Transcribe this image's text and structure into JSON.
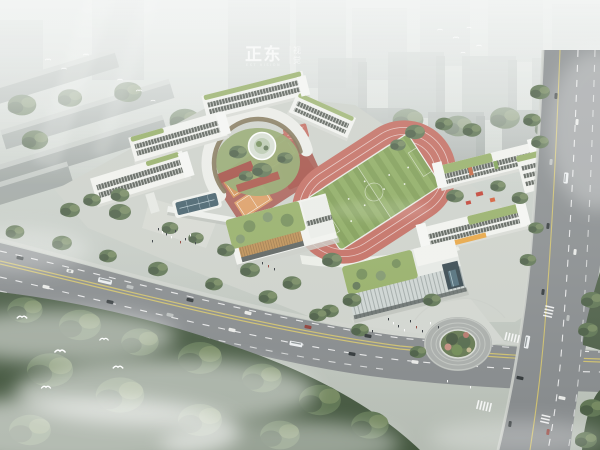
{
  "scene": {
    "description": "Aerial bird's-eye architectural rendering of a school campus with running track, white classroom buildings with green roofs, tree-lined roads, traffic and misty forest",
    "watermark": {
      "title": "正东",
      "subtitle": "EST VISION",
      "side_top": "视",
      "side_bottom": "觉"
    }
  },
  "colors": {
    "haze": "#eef1ef",
    "city_far": "#bcc2c0",
    "city_mid": "#aeb5b2",
    "city_near": "#9da4a1",
    "city_top": "#c6cbc7",
    "tree_dark": "#44573f",
    "tree_mid": "#5d7351",
    "tree_light": "#76895f",
    "tree_band": "#6d8163",
    "campus_ground": "#cdd1ca",
    "plaza_light": "#d6d9d2",
    "building_white": "#f2f3ef",
    "building_shade": "#d8dad4",
    "window_dark": "#565c55",
    "mullion_light": "#e8eae5",
    "roof_green": "#93ad63",
    "roof_tree": "#6f8a53",
    "track_red": "#c2685c",
    "field_green_a": "#8aa95c",
    "field_green_b": "#7b9a4f",
    "court_orange": "#d28c4d",
    "court_orange_light": "#dd9a5f",
    "path_red": "#a2493f",
    "road_gray": "#85898b",
    "road_edge": "#cfd2cc",
    "lane_yellow": "#d5c468",
    "lane_white": "#ffffff",
    "wood_louver": "#bd8d50",
    "wood_louver_dark": "#9c7340",
    "glass_blue": "#3e5a66",
    "glass_wall": "#cdd4d2",
    "glass_line": "#9fa8a6",
    "arc_roof": "#ecede8",
    "arc_facade": "#7a6b4c",
    "island_green": "#63774f",
    "foliage_pink": "#c48d7f",
    "water_blue": "#4d6b78",
    "mist": "#ffffff",
    "car_dark": "#2e3436",
    "car_white": "#e9eae7",
    "car_silver": "#b9bdbc",
    "car_red": "#8d3a32",
    "bus_white": "#eceff1"
  }
}
